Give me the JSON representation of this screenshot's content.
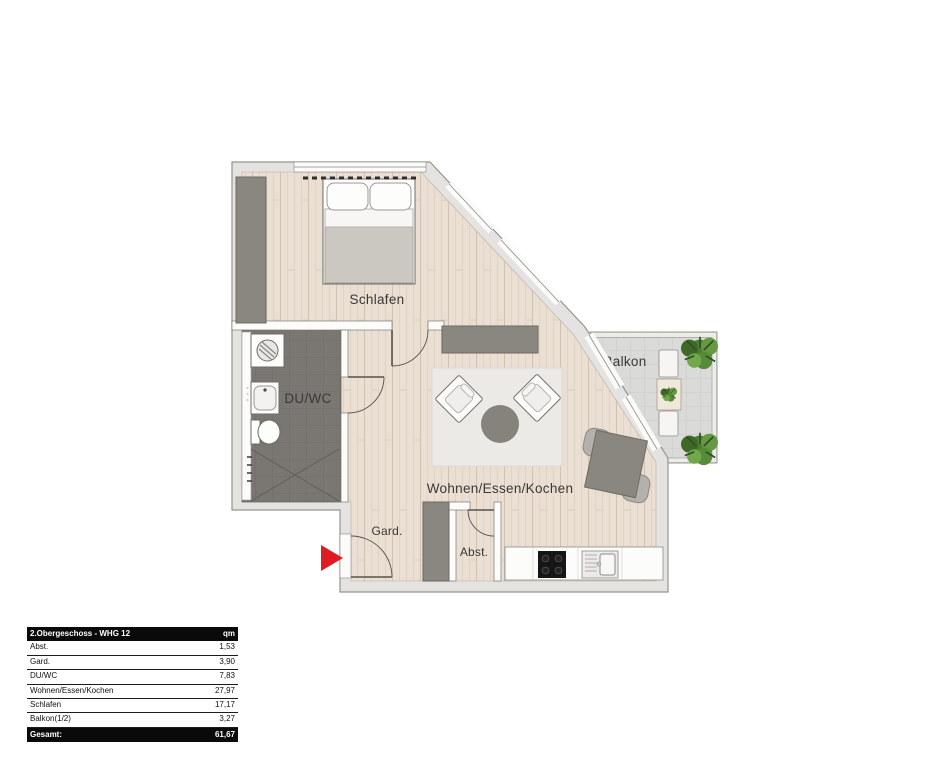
{
  "plan": {
    "rooms": {
      "schlafen": "Schlafen",
      "duwc": "DU/WC",
      "balkon": "Balkon",
      "wohnen": "Wohnen/Essen/Kochen",
      "gard": "Gard.",
      "abst": "Abst."
    },
    "entrance_marker": "entrance-arrow"
  },
  "area_table": {
    "header": {
      "title": "2.Obergeschoss - WHG 12",
      "unit": "qm"
    },
    "rows": [
      {
        "label": "Abst.",
        "value": "1,53"
      },
      {
        "label": "Gard.",
        "value": "3,90"
      },
      {
        "label": "DU/WC",
        "value": "7,83"
      },
      {
        "label": "Wohnen/Essen/Kochen",
        "value": "27,97"
      },
      {
        "label": "Schlafen",
        "value": "17,17"
      },
      {
        "label": "Balkon(1/2)",
        "value": "3,27"
      }
    ],
    "footer": {
      "label": "Gesamt:",
      "value": "61,67"
    }
  },
  "colors": {
    "wall": "#e4e3e1",
    "wood_floor": "#eadfd2",
    "bath_floor": "#7a7772",
    "balcony_floor": "#dadad8",
    "furniture_dark": "#8a8680",
    "entrance_arrow_red": "#e01b22",
    "table_header_bg": "#0a0a0a"
  }
}
